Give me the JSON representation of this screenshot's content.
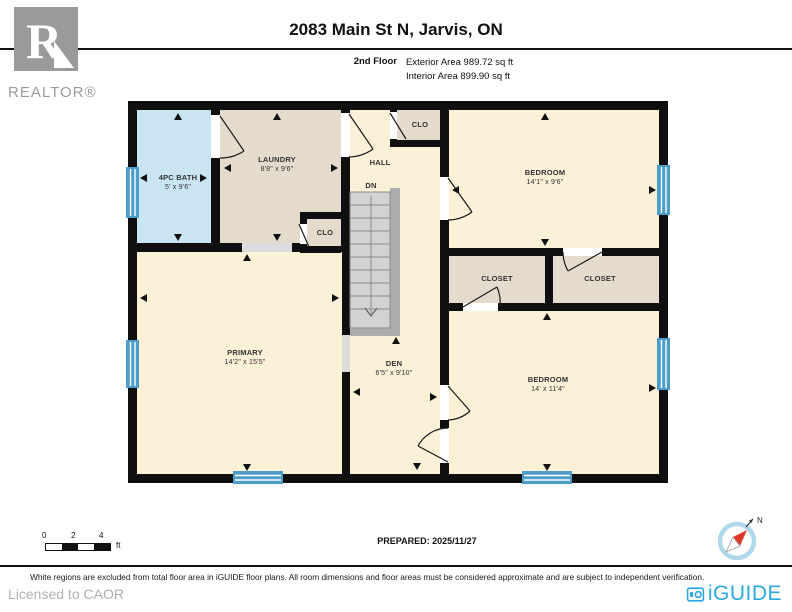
{
  "header": {
    "title": "2083 Main St N, Jarvis, ON",
    "floor_label": "2nd Floor",
    "exterior_area": "Exterior Area 989.72 sq ft",
    "interior_area": "Interior Area 899.90 sq ft",
    "realtor_logo_letter": "R",
    "realtor_logo_text": "REALTOR®"
  },
  "plan": {
    "rooms": {
      "bath": {
        "name": "4PC BATH",
        "dims": "5' x 9'6\""
      },
      "laundry": {
        "name": "LAUNDRY",
        "dims": "8'8\" x 9'6\""
      },
      "clo_top": {
        "name": "CLO"
      },
      "hall": {
        "name": "HALL"
      },
      "stairs": {
        "name": "DN"
      },
      "bedroom_top": {
        "name": "BEDROOM",
        "dims": "14'1\" x 9'6\""
      },
      "closet_left": {
        "name": "CLOSET"
      },
      "closet_right": {
        "name": "CLOSET"
      },
      "clo_mid": {
        "name": "CLO"
      },
      "primary": {
        "name": "PRIMARY",
        "dims": "14'2\" x 15'5\""
      },
      "den": {
        "name": "DEN",
        "dims": "6'5\" x 9'10\""
      },
      "bedroom_bottom": {
        "name": "BEDROOM",
        "dims": "14' x 11'4\""
      }
    }
  },
  "footer": {
    "scale_ticks": [
      "0",
      "2",
      "4"
    ],
    "scale_unit": "ft",
    "prepared": "PREPARED: 2025/11/27",
    "compass_north": "N",
    "disclaimer": "White regions are excluded from total floor area in iGUIDE floor plans. All room dimensions and floor areas must be considered approximate and are subject to independent verification.",
    "licensed_to": "Licensed to CAOR",
    "brand": "iGUIDE"
  },
  "colors": {
    "room_yellow": "#FAF1D6",
    "room_tan": "#E4DBCC",
    "room_blue": "#C9E5F2",
    "window_blue": "#4D9DCB",
    "wall_black": "#0F0F0F",
    "stair_gray": "#D2D2D2",
    "iguide_blue": "#2AA9E0",
    "realtor_gray": "#9A9A9A"
  }
}
